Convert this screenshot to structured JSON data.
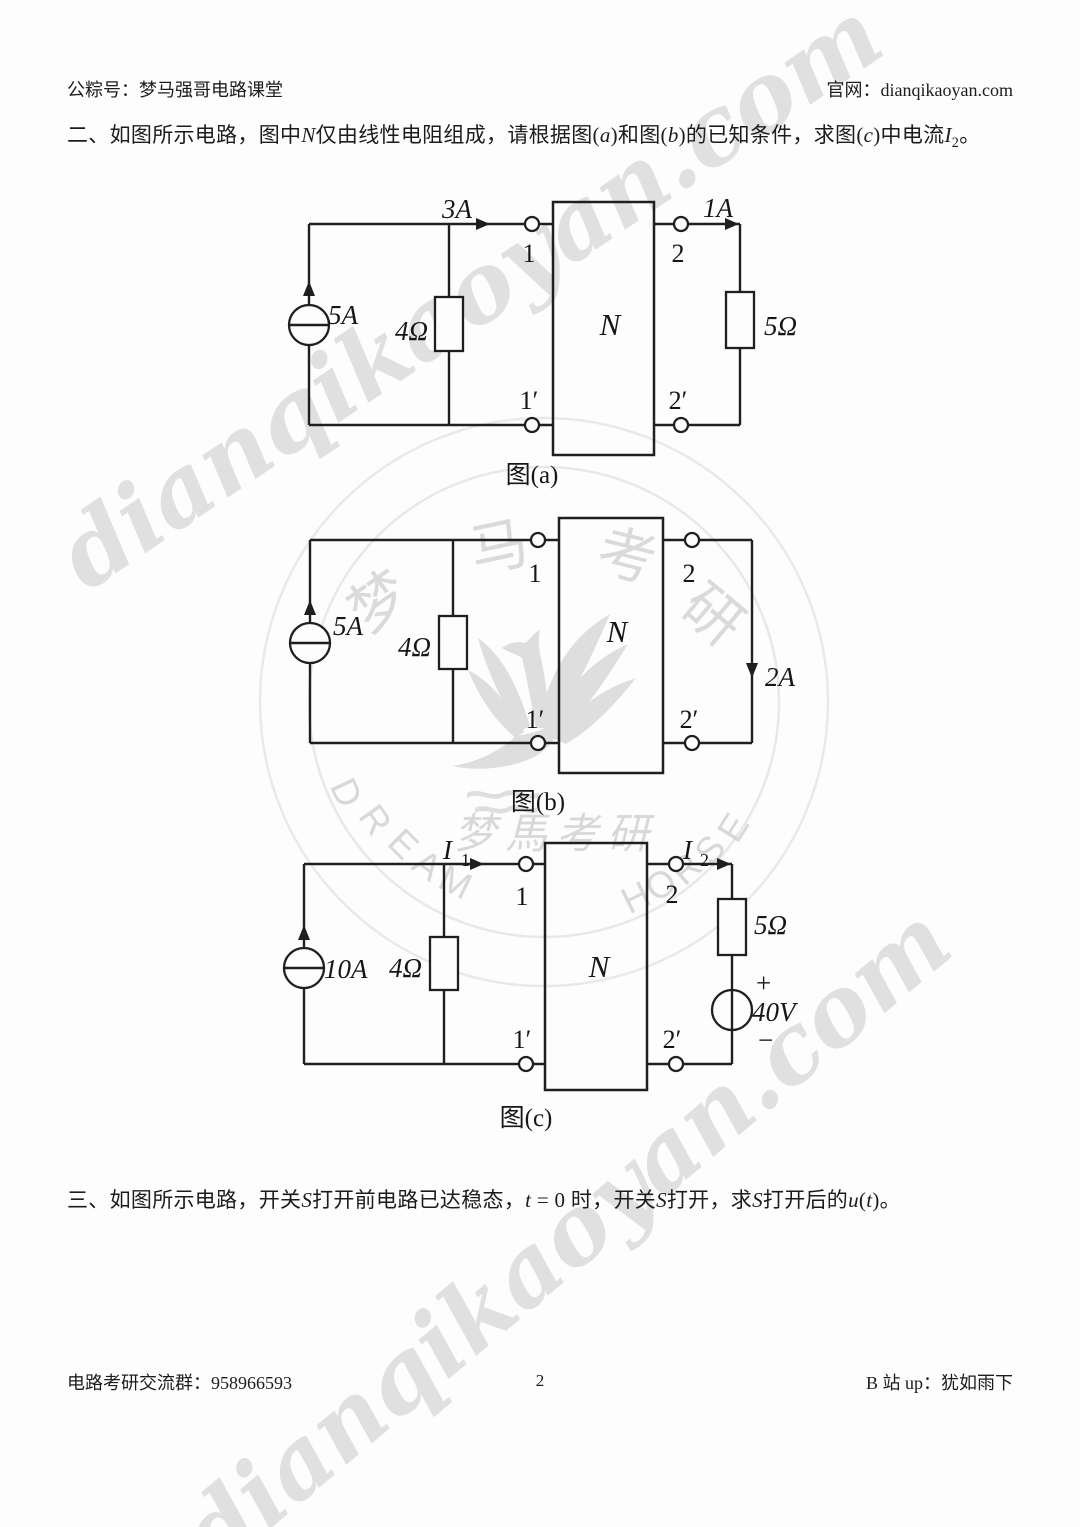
{
  "header": {
    "left": "公粽号：梦马强哥电路课堂",
    "right": "官网：dianqikaoyan.com"
  },
  "question2": {
    "segments": [
      {
        "t": "二、如图所示电路，图中"
      },
      {
        "t": "N",
        "i": 1
      },
      {
        "t": "仅由线性电阻组成，请根据图("
      },
      {
        "t": "a",
        "i": 1
      },
      {
        "t": ")和图("
      },
      {
        "t": "b",
        "i": 1
      },
      {
        "t": ")的已知条件，求图("
      },
      {
        "t": "c",
        "i": 1
      },
      {
        "t": ")中电流"
      },
      {
        "t": "I",
        "i": 1
      },
      {
        "t": "2",
        "sub": 1
      },
      {
        "t": "。"
      }
    ]
  },
  "question3": {
    "segments": [
      {
        "t": "三、如图所示电路，开关"
      },
      {
        "t": "S",
        "i": 1
      },
      {
        "t": "打开前电路已达稳态，"
      },
      {
        "t": "t",
        "i": 1
      },
      {
        "t": " = 0 时，开关"
      },
      {
        "t": "S",
        "i": 1
      },
      {
        "t": "打开，求"
      },
      {
        "t": "S",
        "i": 1
      },
      {
        "t": "打开后的"
      },
      {
        "t": "u",
        "i": 1
      },
      {
        "t": "("
      },
      {
        "t": "t",
        "i": 1
      },
      {
        "t": ")。"
      }
    ]
  },
  "footer": {
    "left": "电路考研交流群：958966593",
    "page_number": "2",
    "right": "B 站 up：犹如雨下"
  },
  "watermark": {
    "diagonal_text": "dianqikaoyan.com",
    "ring_top_characters": [
      "梦",
      "马",
      "考",
      "研"
    ],
    "brand_left": [
      "D",
      "R",
      "E",
      "A",
      "M"
    ],
    "brand_right": [
      "H",
      "O",
      "R",
      "S",
      "E"
    ],
    "script_text": "梦馬考研",
    "color": "#d4d4d4"
  },
  "circuits": {
    "a": {
      "caption": "图(a)",
      "source_current": "5A",
      "shunt_resistor": "4Ω",
      "input_current": "3A",
      "output_current": "1A",
      "load_resistor": "5Ω",
      "network": "N",
      "terminal_1": "1",
      "terminal_1p": "1′",
      "terminal_2": "2",
      "terminal_2p": "2′"
    },
    "b": {
      "caption": "图(b)",
      "source_current": "5A",
      "shunt_resistor": "4Ω",
      "output_current": "2A",
      "network": "N",
      "terminal_1": "1",
      "terminal_1p": "1′",
      "terminal_2": "2",
      "terminal_2p": "2′"
    },
    "c": {
      "caption": "图(c)",
      "source_current": "10A",
      "shunt_resistor": "4Ω",
      "input_current_base": "I",
      "input_current_sub": "1",
      "output_current_base": "I",
      "output_current_sub": "2",
      "load_resistor": "5Ω",
      "voltage_source": "40V",
      "plus_sign": "+",
      "minus_sign": "−",
      "network": "N",
      "terminal_1": "1",
      "terminal_1p": "1′",
      "terminal_2": "2",
      "terminal_2p": "2′"
    }
  }
}
